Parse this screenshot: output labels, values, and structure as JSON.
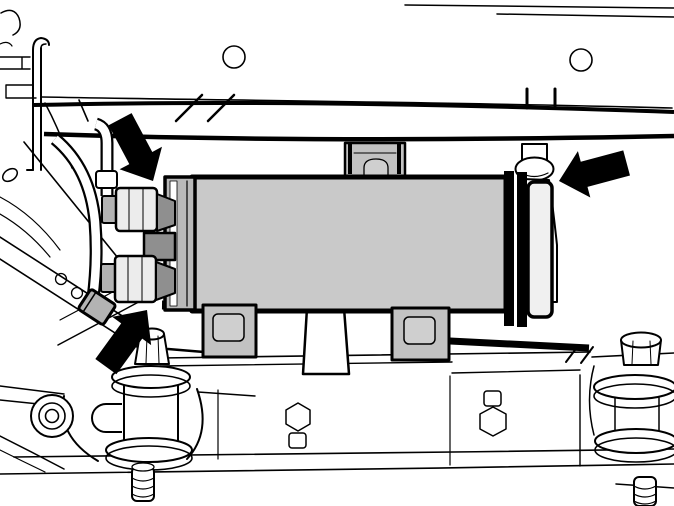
{
  "illustration": {
    "background_color": "#ffffff",
    "line_color": "#000000",
    "fills": {
      "cooler_body": "#c9c9c9",
      "end_cap": "#b9b9b9",
      "cap_stripe": "#ffffff",
      "bracket": "#c2c2c2",
      "bracket_hole": "#cfcfcf",
      "end_plate": "#f0f0f0",
      "fitting_dark": "#8f8f8f",
      "fitting_mid": "#b3b3b3",
      "fitting_nut": "#ececec",
      "arrow": "#000000"
    },
    "arrows": [
      {
        "name": "callout-arrow-upper-fitting",
        "direction": "down-right"
      },
      {
        "name": "callout-arrow-return-pipe",
        "direction": "left"
      },
      {
        "name": "callout-arrow-mount-bolt",
        "direction": "up-right"
      }
    ]
  }
}
